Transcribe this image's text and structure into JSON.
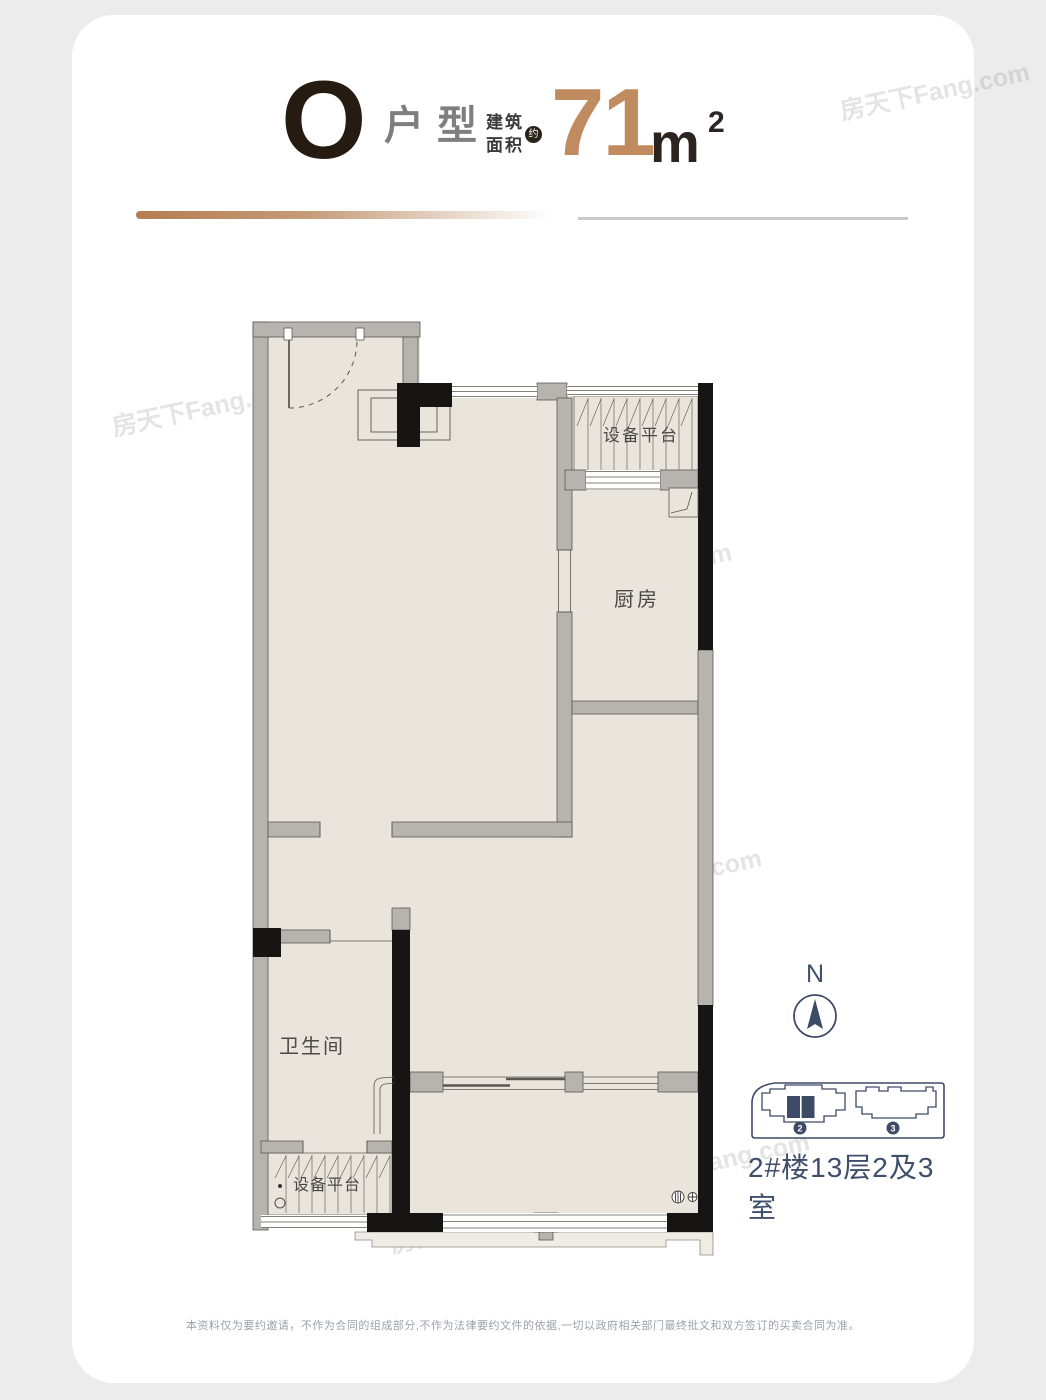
{
  "header": {
    "unit_letter": "O",
    "unit_label": "户型",
    "area_label_top": "建筑",
    "area_label_bottom": "面积",
    "approx": "约",
    "area_value": "71",
    "area_unit": "m",
    "area_sup": "2",
    "accent_color": "#c08c5f",
    "ink_color": "#251b11"
  },
  "floorplan": {
    "labels": {
      "platform_top": "设备平台",
      "kitchen": "厨房",
      "bathroom": "卫生间",
      "platform_bottom": "设备平台"
    },
    "wall_color": "#b7b4b0",
    "floor_color": "#e9e5dc",
    "column_color": "#161513"
  },
  "compass": {
    "north": "N",
    "color": "#3d4b66"
  },
  "keyplan": {
    "building2_badge": "2",
    "building3_badge": "3",
    "caption": "2#楼13层2及3室",
    "color": "#3d4b66"
  },
  "footer": {
    "disclaimer": "本资料仅为要约邀请，不作为合同的组成部分,不作为法律要约文件的依据,一切以政府相关部门最终批文和双方签订的买卖合同为准。"
  },
  "watermark": {
    "text": "房天下Fang.com"
  }
}
